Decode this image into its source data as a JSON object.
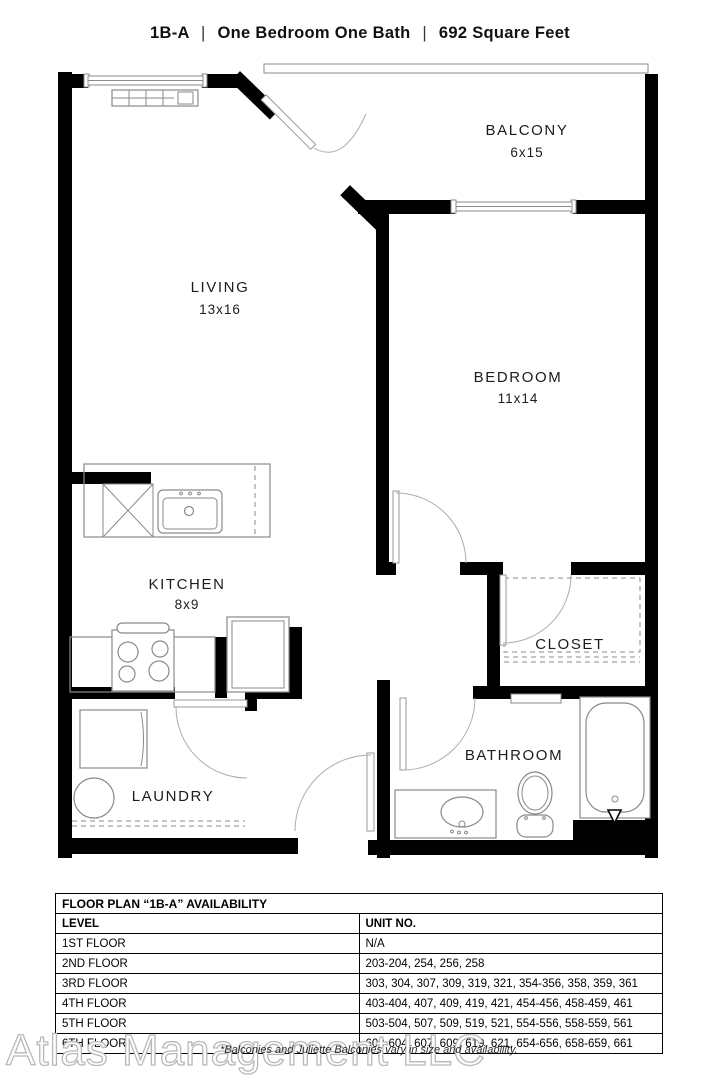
{
  "title": {
    "plan_code": "1B-A",
    "divider": "|",
    "descriptor": "One Bedroom One Bath",
    "square_feet": "692 Square Feet"
  },
  "rooms": {
    "balcony": {
      "name": "BALCONY",
      "dimensions": "6x15"
    },
    "living": {
      "name": "LIVING",
      "dimensions": "13x16"
    },
    "bedroom": {
      "name": "BEDROOM",
      "dimensions": "11x14"
    },
    "kitchen": {
      "name": "KITCHEN",
      "dimensions": "8x9"
    },
    "closet": {
      "name": "CLOSET"
    },
    "bathroom": {
      "name": "BATHROOM"
    },
    "laundry": {
      "name": "LAUNDRY"
    }
  },
  "availability_table": {
    "title": "FLOOR PLAN “1B-A” AVAILABILITY",
    "columns": [
      "LEVEL",
      "UNIT NO."
    ],
    "rows": [
      {
        "level": "1ST FLOOR",
        "units": "N/A"
      },
      {
        "level": "2ND FLOOR",
        "units": "203-204, 254, 256, 258"
      },
      {
        "level": "3RD FLOOR",
        "units": "303, 304, 307, 309, 319, 321, 354-356, 358, 359, 361"
      },
      {
        "level": "4TH FLOOR",
        "units": "403-404, 407, 409, 419, 421, 454-456, 458-459, 461"
      },
      {
        "level": "5TH FLOOR",
        "units": "503-504, 507, 509, 519, 521, 554-556, 558-559, 561"
      },
      {
        "level": "6TH FLOOR",
        "units": "603-604, 607, 609, 619, 621, 654-656, 658-659, 661"
      }
    ]
  },
  "watermark": "Atlas Management LLC",
  "disclaimer": "*Balconies and Juliette Balconies vary in size and availability.",
  "colors": {
    "wall": "#000000",
    "fixture_line": "#8a8a8a",
    "background": "#ffffff",
    "watermark_outline": "#b9b9b9"
  }
}
